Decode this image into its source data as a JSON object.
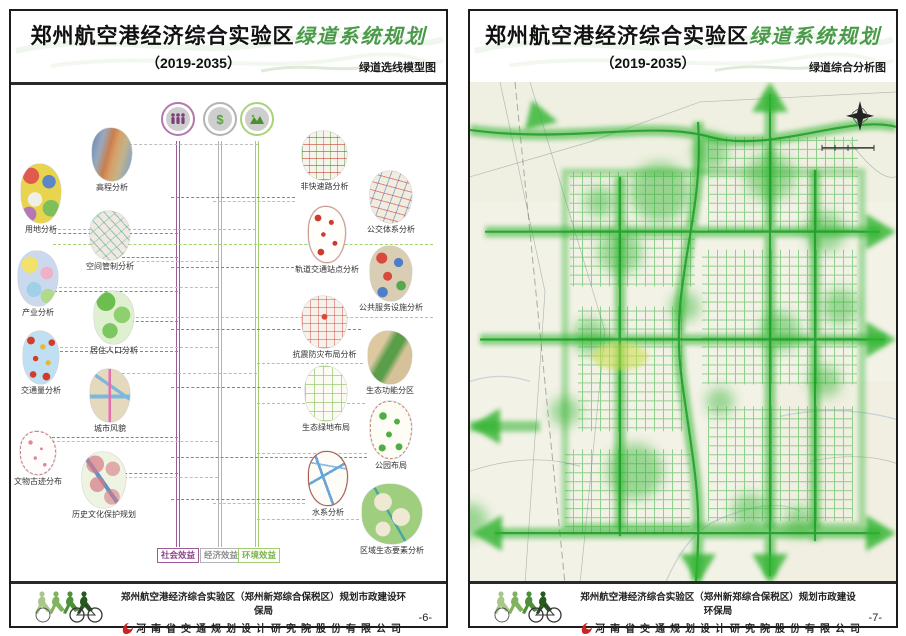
{
  "title": {
    "main": "郑州航空港经济综合实验区",
    "script": "绿道系统规划",
    "period": "（2019-2035）"
  },
  "pages": [
    {
      "subtitle": "绿道选线模型图",
      "page_number": "-6-"
    },
    {
      "subtitle": "绿道综合分析图",
      "page_number": "-7-"
    }
  ],
  "footer": {
    "line1": "郑州航空港经济综合实验区（郑州新郑综合保税区）规划市政建设环保局",
    "line2": "河南省交通规划设计研究院股份有限公司"
  },
  "model_diagram": {
    "benefit_columns": [
      {
        "label": "社会效益",
        "color": "#9c5b98",
        "icon": "people-icon"
      },
      {
        "label": "经济效益",
        "color": "#b3b3b3",
        "icon": "dollar-icon",
        "glyph": "$"
      },
      {
        "label": "环境效益",
        "color": "#9fd06f",
        "icon": "landscape-icon"
      }
    ],
    "left_items": [
      "高程分析",
      "用地分析",
      "空间管制分析",
      "产业分析",
      "居住人口分析",
      "交通量分析",
      "城市风貌",
      "文物古迹分布",
      "历史文化保护规划"
    ],
    "right_items": [
      "非快速路分析",
      "公交体系分析",
      "轨道交通站点分析",
      "公共服务设施分析",
      "抗震防灾布局分析",
      "生态功能分区",
      "生态绿地布局",
      "公园布局",
      "水系分析",
      "区域生态要素分析"
    ]
  },
  "analysis_map": {
    "accent_color": "#2db32d",
    "compass_icon": "north-arrow-icon",
    "scale_bar_icon": "scale-bar-icon"
  }
}
